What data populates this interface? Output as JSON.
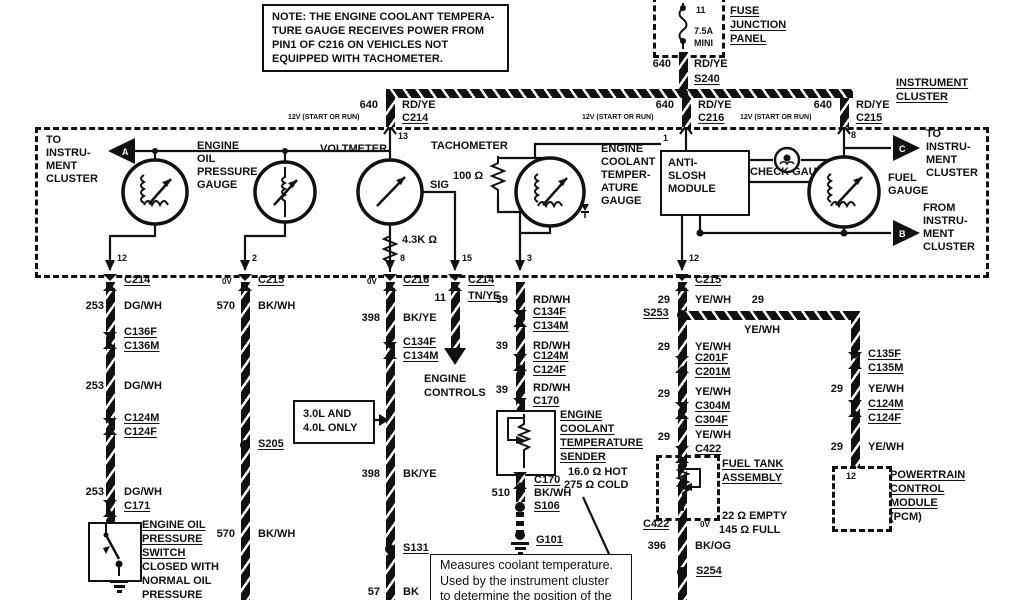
{
  "note": {
    "l1": "NOTE: THE ENGINE COOLANT TEMPERA-",
    "l2": "TURE GAUGE RECEIVES POWER FROM",
    "l3": "PIN1 OF C216  ON VEHICLES NOT",
    "l4": "EQUIPPED WITH TACHOMETER."
  },
  "fuse": {
    "pin": "11",
    "rating": "7.5A",
    "size": "MINI",
    "panel1": "FUSE",
    "panel2": "JUNCTION",
    "panel3": "PANEL",
    "wire_num": "640",
    "wire_color": "RD/YE",
    "splice": "S240"
  },
  "header": {
    "title1": "INSTRUMENT",
    "title2": "CLUSTER",
    "volt": "12V (START OR RUN)",
    "d1_num": "640",
    "d1_color": "RD/YE",
    "d1_conn": "C214",
    "d2_num": "640",
    "d2_color": "RD/YE",
    "d2_conn": "C216",
    "d3_num": "640",
    "d3_color": "RD/YE",
    "d3_conn": "C215"
  },
  "cluster": {
    "a": "A",
    "b": "B",
    "c": "C",
    "to1": "TO",
    "to2": "INSTRU-",
    "to3": "MENT",
    "to4": "CLUSTER",
    "from1": "FROM",
    "from2": "INSTRU-",
    "from3": "MENT",
    "from4": "CLUSTER",
    "oil1": "ENGINE",
    "oil2": "OIL",
    "oil3": "PRESSURE",
    "oil4": "GAUGE",
    "voltmeter": "VOLTMETER",
    "tachometer": "TACHOMETER",
    "sig": "SIG",
    "pin13": "13",
    "pin1": "1",
    "pin8_fuel": "8",
    "r_tach": "4.3K Ω",
    "r_coolant": "100 Ω",
    "cool1": "ENGINE",
    "cool2": "COOLANT",
    "cool3": "TEMPER-",
    "cool4": "ATURE",
    "cool5": "GAUGE",
    "mod1": "ANTI-",
    "mod2": "SLOSH",
    "mod3": "MODULE",
    "check": "CHECK GAUGE",
    "fuel1": "FUEL",
    "fuel2": "GAUGE",
    "pin12a": "12",
    "pin2": "2",
    "pin8": "8",
    "pin15": "15",
    "pin3": "3",
    "pin12b": "12"
  },
  "col1": {
    "conn": "C214",
    "num": "253",
    "color": "DG/WH",
    "c2a": "C136F",
    "c2b": "C136M",
    "c3a": "C124M",
    "c3b": "C124F",
    "conn4": "C171",
    "sw1": "ENGINE OIL",
    "sw2": "PRESSURE",
    "sw3": "SWITCH",
    "n1": "CLOSED WITH",
    "n2": "NORMAL OIL",
    "n3": "PRESSURE"
  },
  "col2": {
    "ov": "0V",
    "conn": "C215",
    "num": "570",
    "color": "BK/WH",
    "splice": "S205"
  },
  "col3": {
    "ov": "0V",
    "conn": "C216",
    "num": "398",
    "color": "BK/YE",
    "c2a": "C134F",
    "c2b": "C134M",
    "note1": "3.0L AND",
    "note2": "4.0L ONLY",
    "splice": "S131",
    "num2": "57",
    "color2": "BK"
  },
  "col4": {
    "conn": "C214",
    "num": "11",
    "color": "TN/YE",
    "dest1": "ENGINE",
    "dest2": "CONTROLS"
  },
  "col5": {
    "num": "39",
    "color": "RD/WH",
    "c1a": "C134F",
    "c1b": "C134M",
    "c2a": "C124M",
    "c2b": "C124F",
    "conn3": "C170",
    "s1": "ENGINE",
    "s2": "COOLANT",
    "s3": "TEMPERATURE",
    "s4": "SENDER",
    "hot": "16.0 Ω HOT",
    "cold": "275 Ω COLD",
    "conn4": "C170",
    "num2": "510",
    "color2": "BK/WH",
    "splice": "S106",
    "ground": "G101",
    "co1": "Measures coolant temperature.",
    "co2": "Used by the instrument cluster",
    "co3": "to determine the position of the"
  },
  "col6": {
    "conn": "C215",
    "num": "29",
    "color": "YE/WH",
    "splice": "S253",
    "bnum": "29",
    "bcolor": "YE/WH",
    "c2a": "C201F",
    "c2b": "C201M",
    "c3a": "C304M",
    "c3b": "C304F",
    "conn4": "C422",
    "t1": "FUEL TANK",
    "t2": "ASSEMBLY",
    "conn5": "C422",
    "ov": "0V",
    "empty": "22 Ω EMPTY",
    "full": "145 Ω FULL",
    "num2": "396",
    "color2": "BK/OG",
    "splice2": "S254"
  },
  "col7": {
    "c1a": "C135F",
    "c1b": "C135M",
    "num": "29",
    "color": "YE/WH",
    "c2a": "C124M",
    "c2b": "C124F",
    "pin": "12",
    "p1": "POWERTRAIN",
    "p2": "CONTROL",
    "p3": "MODULE",
    "p4": "(PCM)"
  }
}
